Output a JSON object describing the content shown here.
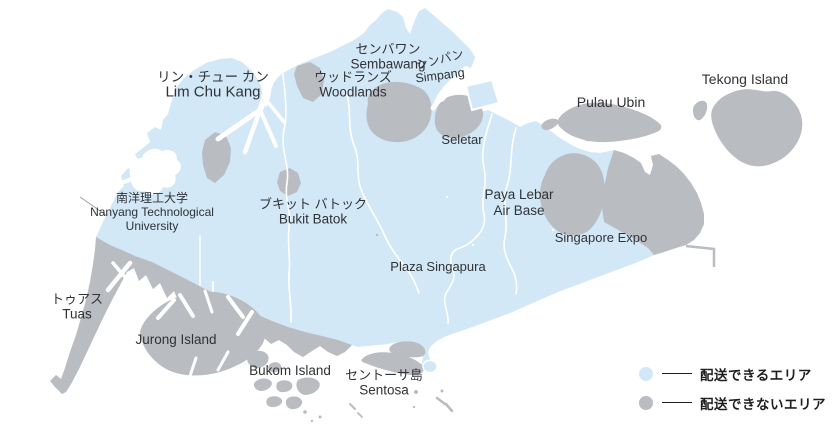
{
  "colors": {
    "deliverable_area": "#d2e8f7",
    "non_deliverable_area": "#b9bdc2",
    "sea": "#ffffff",
    "label_text": "#303236",
    "legend_text": "#1d1e20"
  },
  "labels": {
    "lim_chu_kang": {
      "jp": "リン・チュー カン",
      "en": "Lim Chu Kang"
    },
    "sembawang": {
      "jp": "センバワン",
      "en": "Sembawang"
    },
    "woodlands": {
      "jp": "ウッドランズ",
      "en": "Woodlands"
    },
    "simpang": {
      "jp": "シンパン",
      "en": "Simpang"
    },
    "tekong_island": {
      "en": "Tekong Island"
    },
    "pulau_ubin": {
      "en": "Pulau Ubin"
    },
    "seletar": {
      "en": "Seletar"
    },
    "nanyang_technological_university": {
      "jp": "南洋理工大学",
      "en_line1": "Nanyang Technological",
      "en_line2": "University"
    },
    "bukit_batok": {
      "jp": "ブキット バトック",
      "en": "Bukit Batok"
    },
    "paya_lebar_air_base": {
      "en_line1": "Paya Lebar",
      "en_line2": "Air Base"
    },
    "singapore_expo": {
      "en": "Singapore Expo"
    },
    "plaza_singapura": {
      "en": "Plaza Singapura"
    },
    "tuas": {
      "jp": "トゥアス",
      "en": "Tuas"
    },
    "jurong_island": {
      "en": "Jurong Island"
    },
    "bukom_island": {
      "en": "Bukom Island"
    },
    "sentosa": {
      "jp": "セントーサ島",
      "en": "Sentosa"
    }
  },
  "legend": {
    "items": [
      {
        "id": "deliverable",
        "label": "配送できるエリア",
        "color": "#d2e8f7"
      },
      {
        "id": "non_deliverable",
        "label": "配送できないエリア",
        "color": "#b9bdc2"
      }
    ]
  }
}
